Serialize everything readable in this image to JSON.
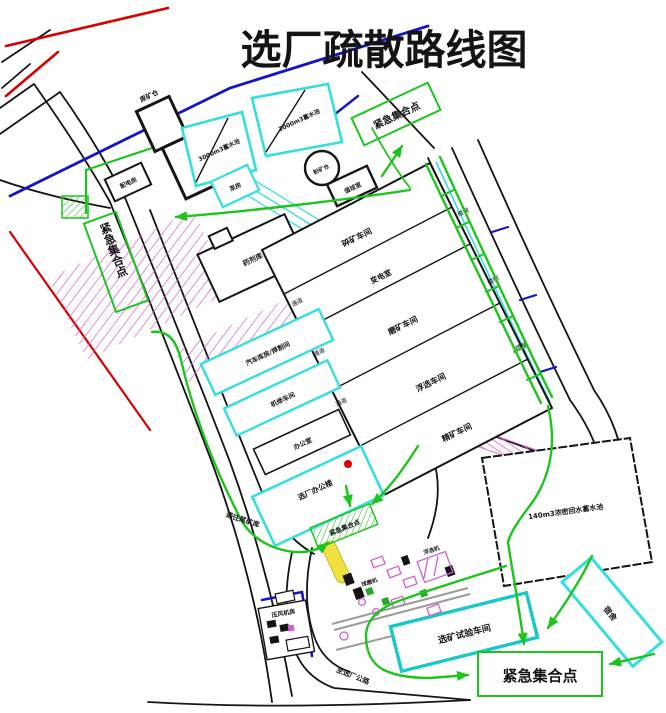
{
  "title": {
    "text": "选厂疏散路线图",
    "color": "#23c523"
  },
  "colors": {
    "route_green": "#1ec41e",
    "building_cyan": "#35dede",
    "building_teal": "#17c8c8",
    "line_blue": "#1414c8",
    "road_black": "#141414",
    "accent_red": "#d90000",
    "hatch_magenta": "#cf5fd0"
  },
  "labels": {
    "assembly_point": "紧急集合点",
    "ore_bin": "原矿仓",
    "pond_a": "3000m3蓄水池",
    "pond_b": "3000m3蓄水池",
    "pump_house": "泵房",
    "power_room": "配电房",
    "fine_ore_bin": "粉矿仓",
    "duty_room": "值班室",
    "lab": "化验室",
    "reagent_store": "药剂库",
    "crushing": "碎矿车间",
    "substation": "变电室",
    "grinding": "磨矿车间",
    "flotation": "浮选车间",
    "concentrate": "精矿车间",
    "corridor": "通道",
    "stairs": "楼梯",
    "garage": "汽车库房/焊割间",
    "repair_shop": "机修车间",
    "office_small": "办公室",
    "office_main": "选厂办公楼",
    "thickener_pond": "140m3浓密回水蓄水池",
    "dorm": "宿舍",
    "test_workshop": "选矿试验车间",
    "compressor_room": "压风机房",
    "ball_mill": "球磨机",
    "flotation_cells": "浮选机",
    "road_to_tailings": "通往尾矿库",
    "road_to_plant": "至选厂公路"
  }
}
